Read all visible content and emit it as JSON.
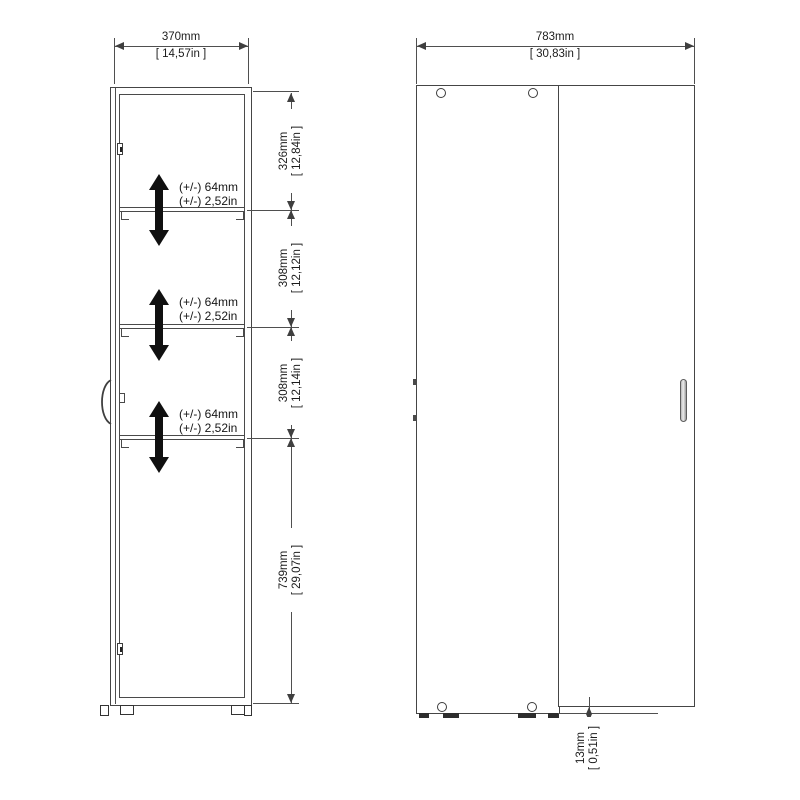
{
  "side_view": {
    "depth_dim": {
      "mm": "370mm",
      "in": "[ 14,57in ]"
    },
    "adjust_label": {
      "line1": "(+/-) 64mm",
      "line2": "(+/-) 2,52in"
    },
    "height_dims": [
      {
        "mm": "326mm",
        "in": "[ 12,84in ]"
      },
      {
        "mm": "308mm",
        "in": "[ 12,12in ]"
      },
      {
        "mm": "308mm",
        "in": "[ 12,14in ]"
      },
      {
        "mm": "739mm",
        "in": "[ 29,07in ]"
      }
    ]
  },
  "front_view": {
    "width_dim": {
      "mm": "783mm",
      "in": "[ 30,83in ]"
    },
    "base_gap_dim": {
      "mm": "13mm",
      "in": "[ 0,51in ]"
    }
  },
  "colors": {
    "line": "#454545",
    "text": "#1c1c1c",
    "arrow": "#101010",
    "background": "#ffffff",
    "handle_fill": "#d9d9d9"
  }
}
